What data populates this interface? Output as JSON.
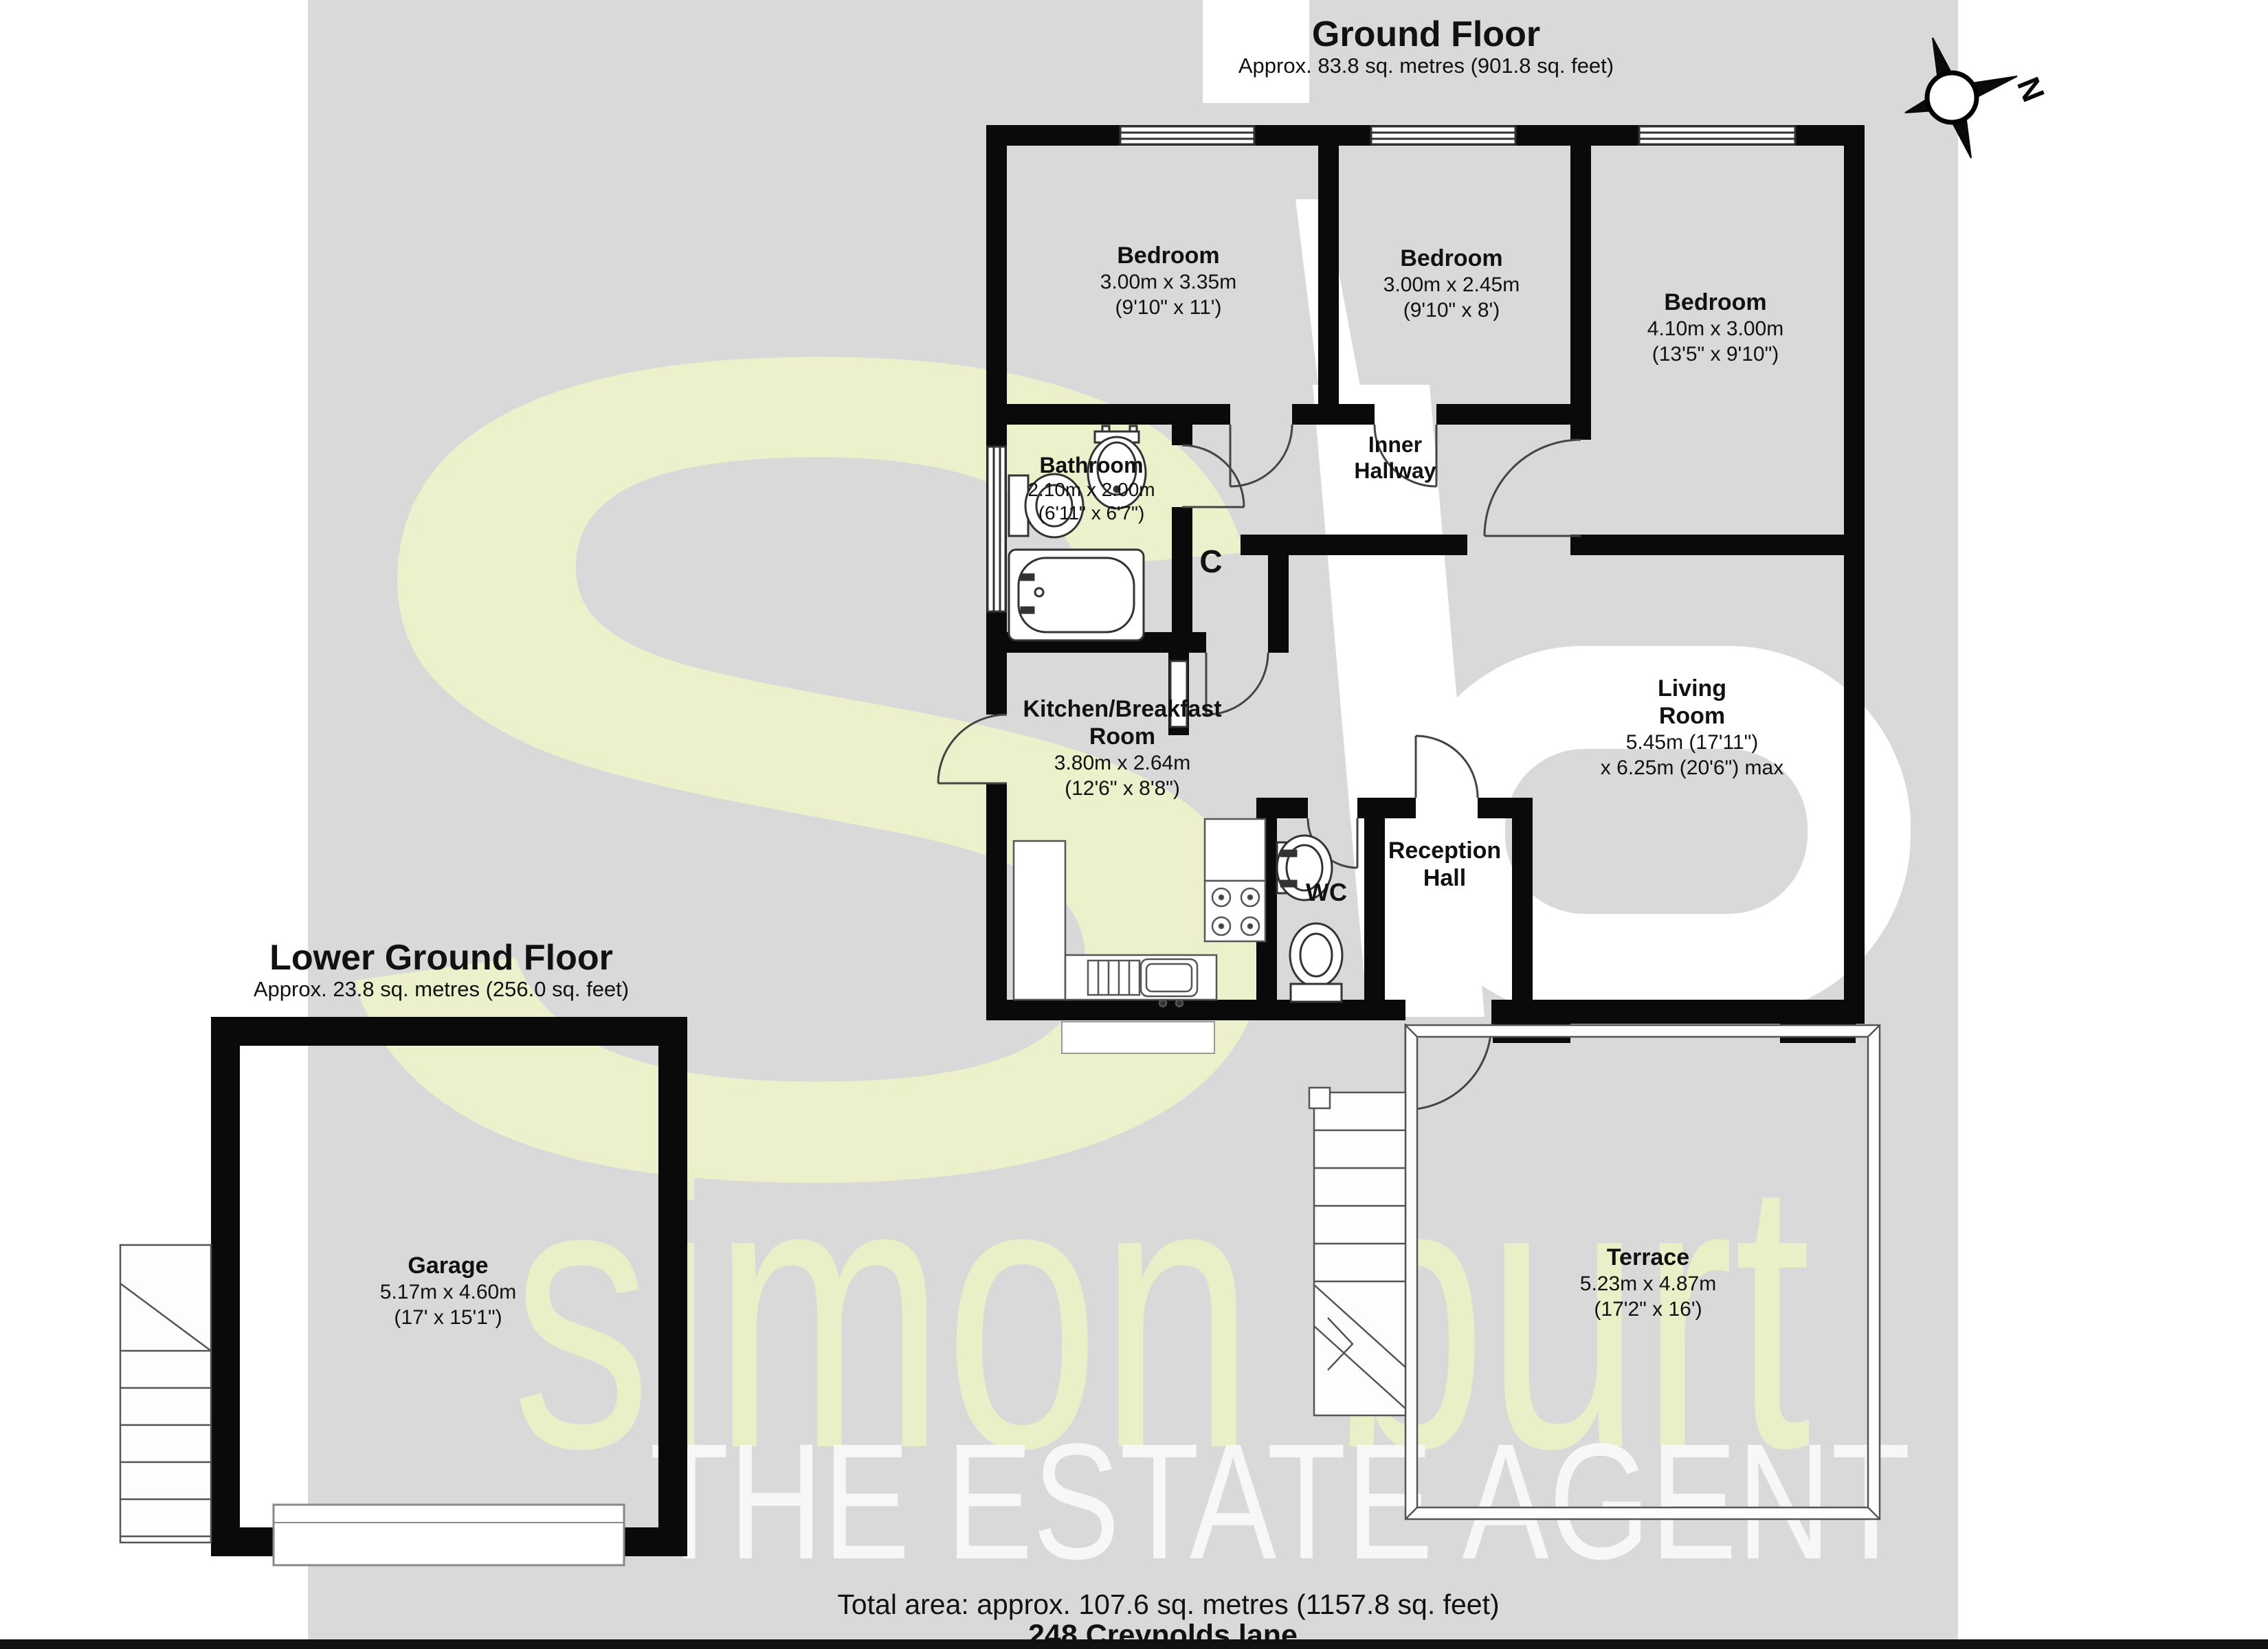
{
  "ground_floor": {
    "title": "Ground Floor",
    "area": "Approx. 83.8 sq. metres (901.8 sq. feet)"
  },
  "lower_ground_floor": {
    "title": "Lower Ground Floor",
    "area": "Approx. 23.8 sq. metres (256.0 sq. feet)"
  },
  "rooms": {
    "bedroom1": {
      "name": "Bedroom",
      "metric": "3.00m x 3.35m",
      "imperial": "(9'10\" x 11')"
    },
    "bedroom2": {
      "name": "Bedroom",
      "metric": "3.00m x 2.45m",
      "imperial": "(9'10\" x 8')"
    },
    "bedroom3": {
      "name": "Bedroom",
      "metric": "4.10m x 3.00m",
      "imperial": "(13'5\" x 9'10\")"
    },
    "bathroom": {
      "name": "Bathroom",
      "metric": "2.10m x 2.00m",
      "imperial": "(6'11\" x 6'7\")"
    },
    "inner_hallway": {
      "line1": "Inner",
      "line2": "Hallway"
    },
    "cupboard": {
      "name": "C"
    },
    "kitchen": {
      "line1": "Kitchen/Breakfast",
      "line2": "Room",
      "metric": "3.80m x 2.64m",
      "imperial": "(12'6\" x 8'8\")"
    },
    "living_room": {
      "line1": "Living",
      "line2": "Room",
      "metric": "5.45m (17'11\")",
      "imperial": "x 6.25m (20'6\") max"
    },
    "wc": {
      "name": "WC"
    },
    "reception_hall": {
      "line1": "Reception",
      "line2": "Hall"
    },
    "garage": {
      "name": "Garage",
      "metric": "5.17m x 4.60m",
      "imperial": "(17' x 15'1\")"
    },
    "terrace": {
      "name": "Terrace",
      "metric": "5.23m x 4.87m",
      "imperial": "(17'2\" x 16')"
    }
  },
  "footer": {
    "total_area": "Total area: approx. 107.6 sq. metres (1157.8 sq. feet)",
    "address": "248 Creynolds lane"
  },
  "watermark": {
    "monogram_s": "s",
    "brand": "simon burt",
    "tagline": "THE ESTATE AGENT"
  },
  "compass": {
    "north_label": "N"
  },
  "colors": {
    "watermark_gray": "#d9d9d9",
    "watermark_green": "#ecf1cb",
    "wall_black": "#0a0a0a"
  }
}
